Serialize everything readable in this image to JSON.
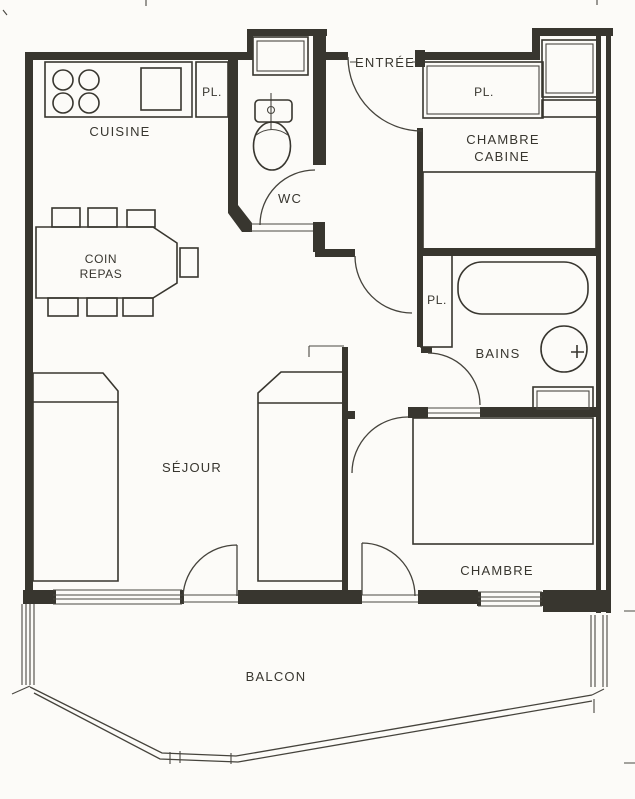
{
  "document": {
    "kind": "apartment floor plan (scanned line drawing)"
  },
  "labels": {
    "entree": "ENTRÉE",
    "cuisine": "CUISINE",
    "coin_repas_line1": "COIN",
    "coin_repas_line2": "REPAS",
    "pl_kitchen": "PL.",
    "pl_cabine": "PL.",
    "pl_bains": "PL.",
    "wc": "WC",
    "chambre_cabine_line1": "CHAMBRE",
    "chambre_cabine_line2": "CABINE",
    "bains": "BAINS",
    "sejour": "SÉJOUR",
    "chambre": "CHAMBRE",
    "balcon": "BALCON"
  },
  "fixtures": {
    "stove_burners": 4,
    "kitchen_sink": 1,
    "water_heater": 1,
    "toilet": 1,
    "bathtub": 1,
    "washbasin": 1,
    "bathroom_cabinet": 1,
    "dining_table": 1,
    "dining_chairs": 7,
    "beds": 4,
    "interior_doors": 5,
    "balcony_doors": 2
  },
  "colors": {
    "ink": "#38362f",
    "paper": "#fcfbf8"
  }
}
